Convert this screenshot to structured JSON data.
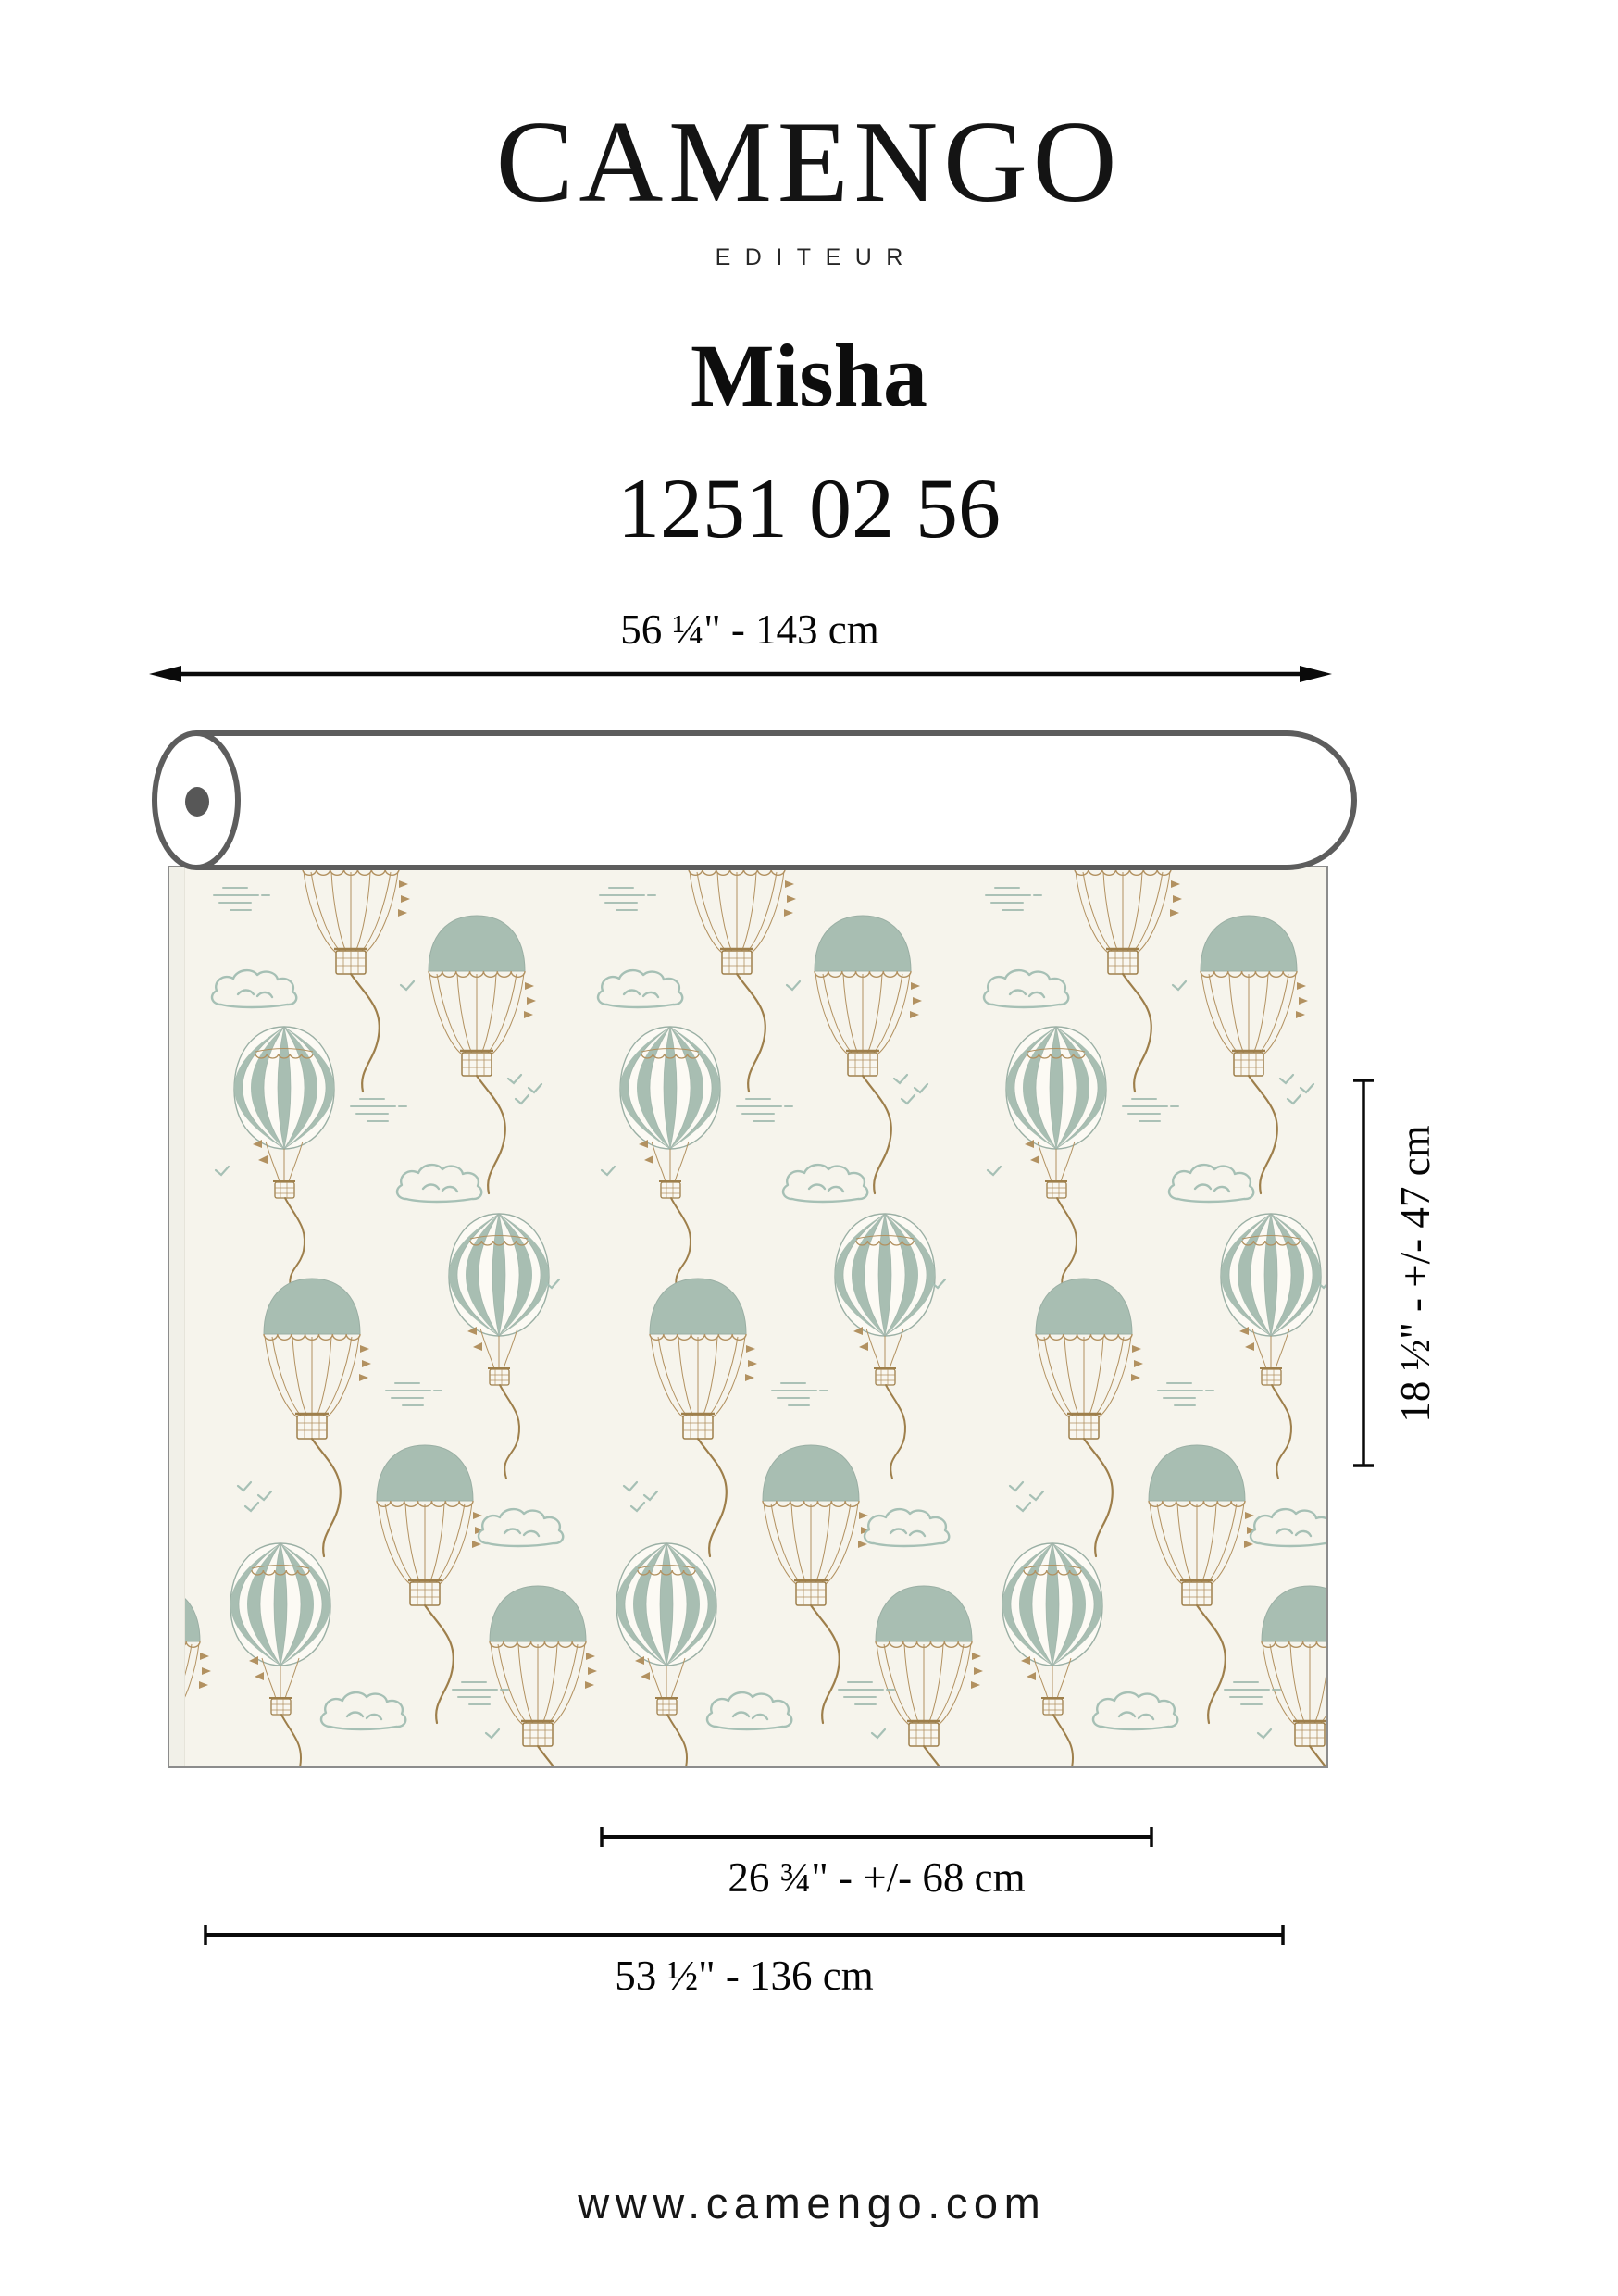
{
  "brand": {
    "logo": "CAMENGO",
    "tagline": "EDITEUR"
  },
  "product": {
    "name": "Misha",
    "reference": "1251 02 56"
  },
  "diagram": {
    "roll_width_label": "56 ¼\" - 143 cm",
    "vertical_repeat_label": "18 ½\" - +/- 47 cm",
    "horizontal_repeat_label": "26 ¾\" - +/- 68 cm",
    "fabric_width_label": "53 ½\" - 136 cm",
    "motifs": [
      "hot-air-balloon-dome",
      "hot-air-balloon-striped",
      "cloud",
      "birds",
      "dashes"
    ],
    "colors": {
      "fabric_background": "#f6f4ec",
      "selvage": "#f1f0e8",
      "balloon_sage": "#a8beb2",
      "motif_outline_sage": "#a6c0b5",
      "basket_gold": "#b29160",
      "rope_tan": "#9e7f4b",
      "roll_outline_gray": "#5d5d5d",
      "dimension_line_black": "#0a0a0a"
    }
  },
  "footer": {
    "website": "www.camengo.com"
  }
}
